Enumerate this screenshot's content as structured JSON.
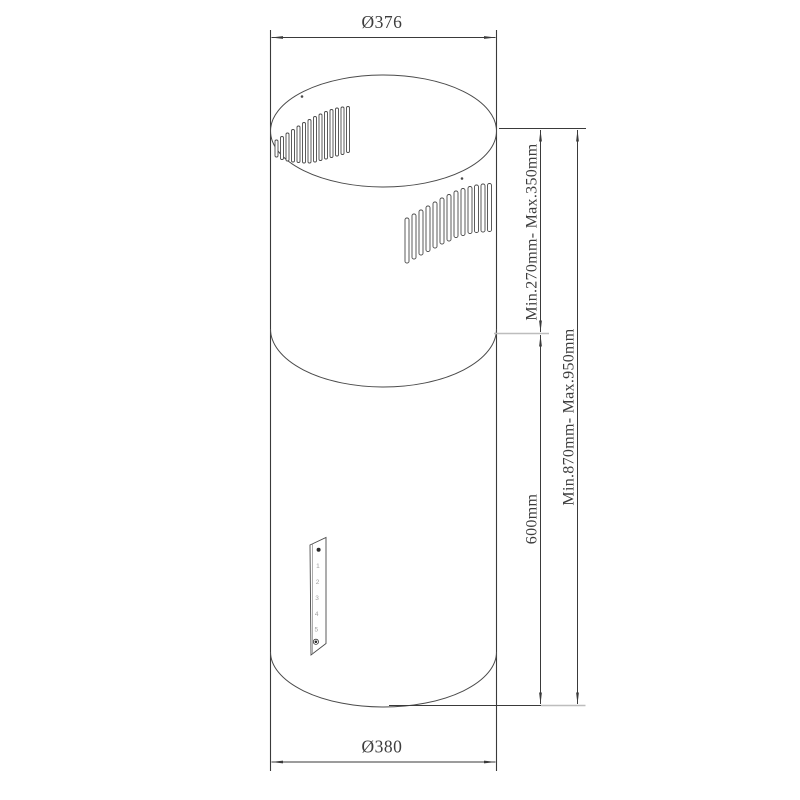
{
  "dimensions": {
    "top_diameter": "Ø376",
    "bottom_diameter": "Ø380",
    "chimney_height": "Min.270mm- Max.350mm",
    "total_height": "Min.870mm- Max.950mm",
    "body_height": "600mm"
  },
  "control_panel": {
    "speed_labels": [
      "1",
      "2",
      "3",
      "4",
      "5"
    ],
    "power_icon": "power-dot-icon",
    "light_icon": "light-button-icon"
  },
  "colors": {
    "line": "#3a3a3a",
    "light_line": "#bdbdbd",
    "text": "#3d3d3d",
    "panel_text": "#a0a0a0",
    "background": "#ffffff"
  }
}
